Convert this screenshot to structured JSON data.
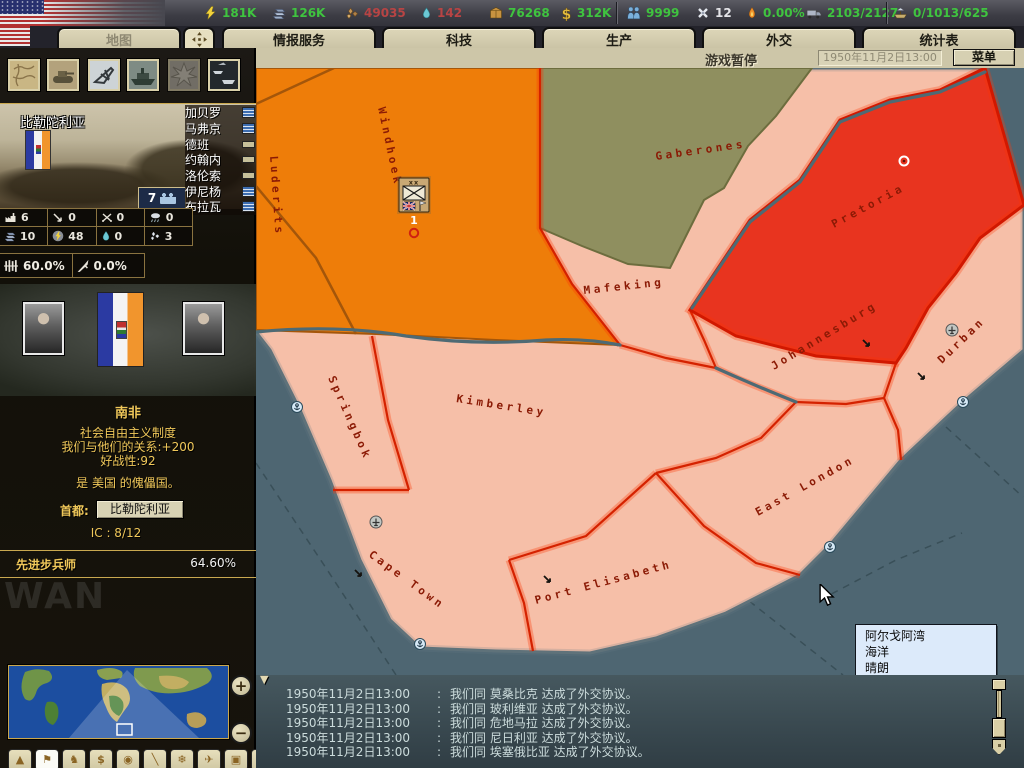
{
  "top_bar": {
    "resources": [
      {
        "id": "energy",
        "value": "181K",
        "tone": "g"
      },
      {
        "id": "metal",
        "value": "126K",
        "tone": "g"
      },
      {
        "id": "rare_materials",
        "value": "49035",
        "tone": "r"
      },
      {
        "id": "oil",
        "value": "142",
        "tone": "r"
      },
      {
        "id": "supplies",
        "value": "76268",
        "tone": "g"
      },
      {
        "id": "money",
        "value": "312K",
        "tone": "g"
      },
      {
        "id": "manpower",
        "value": "9999",
        "tone": "g"
      },
      {
        "id": "transports",
        "value": "12",
        "tone": "w"
      },
      {
        "id": "dissent",
        "value": "0.00%",
        "tone": "g"
      },
      {
        "id": "transport_capacity",
        "value": "2103/2127",
        "tone": "g"
      },
      {
        "id": "convoys",
        "value": "0/1013/625",
        "tone": "g"
      }
    ]
  },
  "tabs": {
    "map": "地图",
    "intelligence": "情报服务",
    "technology": "科技",
    "production": "生产",
    "diplomacy": "外交",
    "statistics": "统计表"
  },
  "toolbar": {
    "pause": "游戏暂停",
    "date": "1950年11月2日13:00",
    "menu": "菜单"
  },
  "sidebar": {
    "province": {
      "name": "比勒陀利亚",
      "divisions": "7",
      "cities": [
        {
          "name": "加贝罗",
          "marker": "wave"
        },
        {
          "name": "马弗京",
          "marker": "wave"
        },
        {
          "name": "德班",
          "marker": "bar"
        },
        {
          "name": "约翰内",
          "marker": "bar"
        },
        {
          "name": "洛伦索",
          "marker": "bar"
        },
        {
          "name": "伊尼杨",
          "marker": "wave"
        },
        {
          "name": "布拉瓦",
          "marker": "wave"
        }
      ],
      "stats": {
        "ic": "6",
        "aa": "0",
        "battles": "0",
        "weather": "0",
        "metal": "10",
        "energy": "48",
        "oil": "0",
        "rare_materials": "3",
        "infrastructure": "60.0%",
        "revolt_risk": "0.0%"
      }
    },
    "country": {
      "name": "南非",
      "government": "社会自由主义制度",
      "relations": "我们与他们的关系:+200",
      "belligerence": "好战性:92",
      "puppet_note": "是 美国 的傀儡国。",
      "capital_label": "首都:",
      "capital": "比勒陀利亚",
      "ic_line": "IC : 8/12"
    },
    "research": {
      "name": "先进步兵师",
      "progress": "64.60%"
    },
    "watermark": "WAN",
    "map_modes": {
      "icons": [
        "▲",
        "⚑",
        "♞",
        "$",
        "◉",
        "╲",
        "❄",
        "✈",
        "▣",
        "●"
      ]
    }
  },
  "map": {
    "labels": {
      "windhoek": "Windhoek",
      "luderits": "Luderits",
      "gaberones": "Gaberones",
      "pretoria": "Pretoria",
      "mafeking": "Mafeking",
      "johannesburg": "Johannesburg",
      "durban": "Durban",
      "kimberley": "Kimberley",
      "springbok": "Springbok",
      "cape_town": "Cape Town",
      "port_elisabeth": "Port Elisabeth",
      "east_london": "East London"
    },
    "unit_echelon": "xx",
    "unit_count": "1",
    "tooltip": {
      "line1": "阿尔戈阿湾",
      "line2": "海洋",
      "line3": "晴朗"
    }
  },
  "log": {
    "separator": ":",
    "entries": [
      {
        "time": "1950年11月2日13:00",
        "message": "我们同 莫桑比克 达成了外交协议。"
      },
      {
        "time": "1950年11月2日13:00",
        "message": "我们同 玻利维亚 达成了外交协议。"
      },
      {
        "time": "1950年11月2日13:00",
        "message": "我们同 危地马拉 达成了外交协议。"
      },
      {
        "time": "1950年11月2日13:00",
        "message": "我们同 尼日利亚 达成了外交协议。"
      },
      {
        "time": "1950年11月2日13:00",
        "message": "我们同 埃塞俄比亚 达成了外交协议。"
      }
    ]
  },
  "colors": {
    "selected_province": "#e8341f",
    "owned_province": "#f6bfa8",
    "sea": "#4e6672",
    "accent_gold": "#f0c85a"
  }
}
